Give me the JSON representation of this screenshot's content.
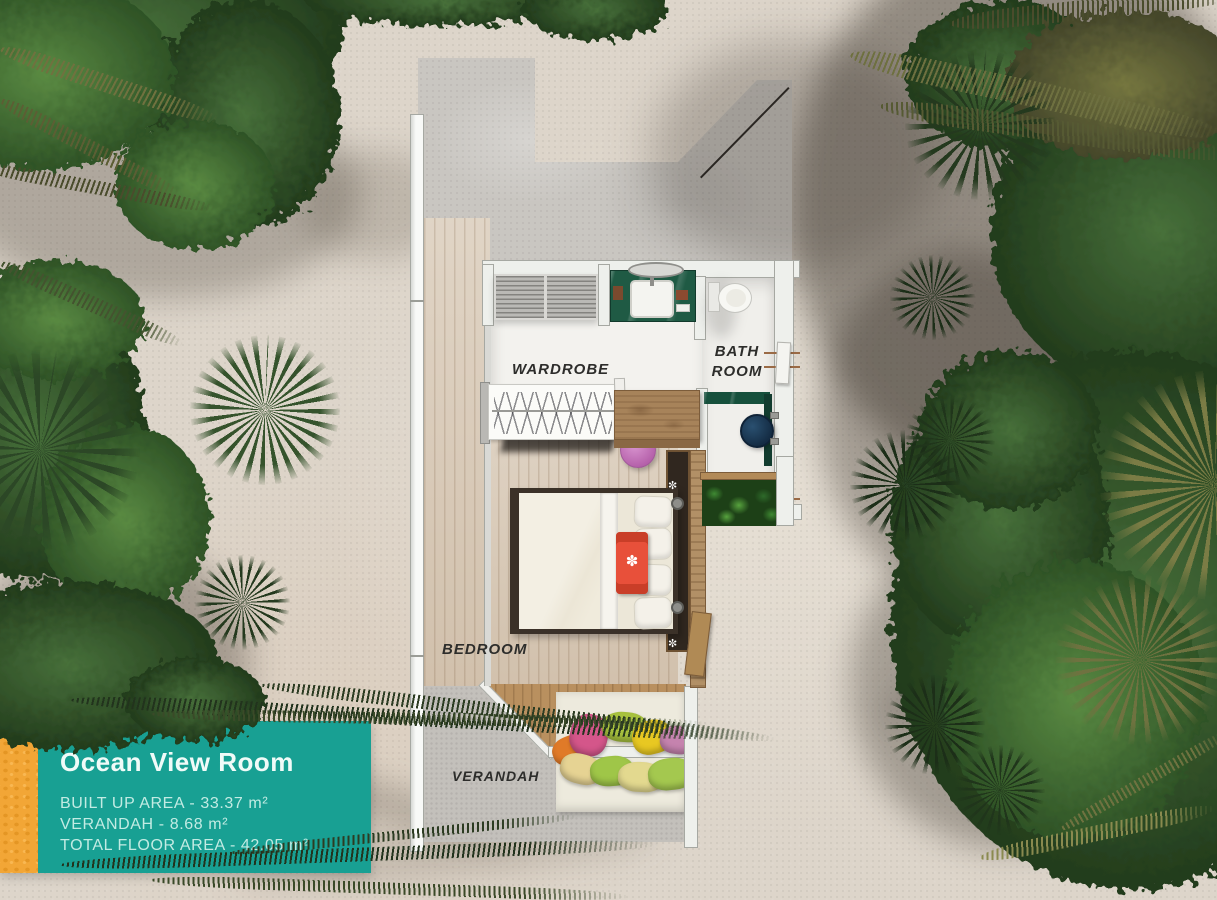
{
  "card": {
    "title": "Ocean View Room",
    "specs": [
      "BUILT UP AREA - 33.37 m²",
      "VERANDAH - 8.68 m²",
      "TOTAL FLOOR AREA - 42.05 m²"
    ],
    "panel_color": "#18a093",
    "stripe_color": "#f2a636"
  },
  "plan": {
    "labels": {
      "wardrobe": "WARDROBE",
      "bathroom_line1": "BATH",
      "bathroom_line2": "ROOM",
      "bedroom": "BEDROOM",
      "verandah": "VERANDAH"
    }
  }
}
